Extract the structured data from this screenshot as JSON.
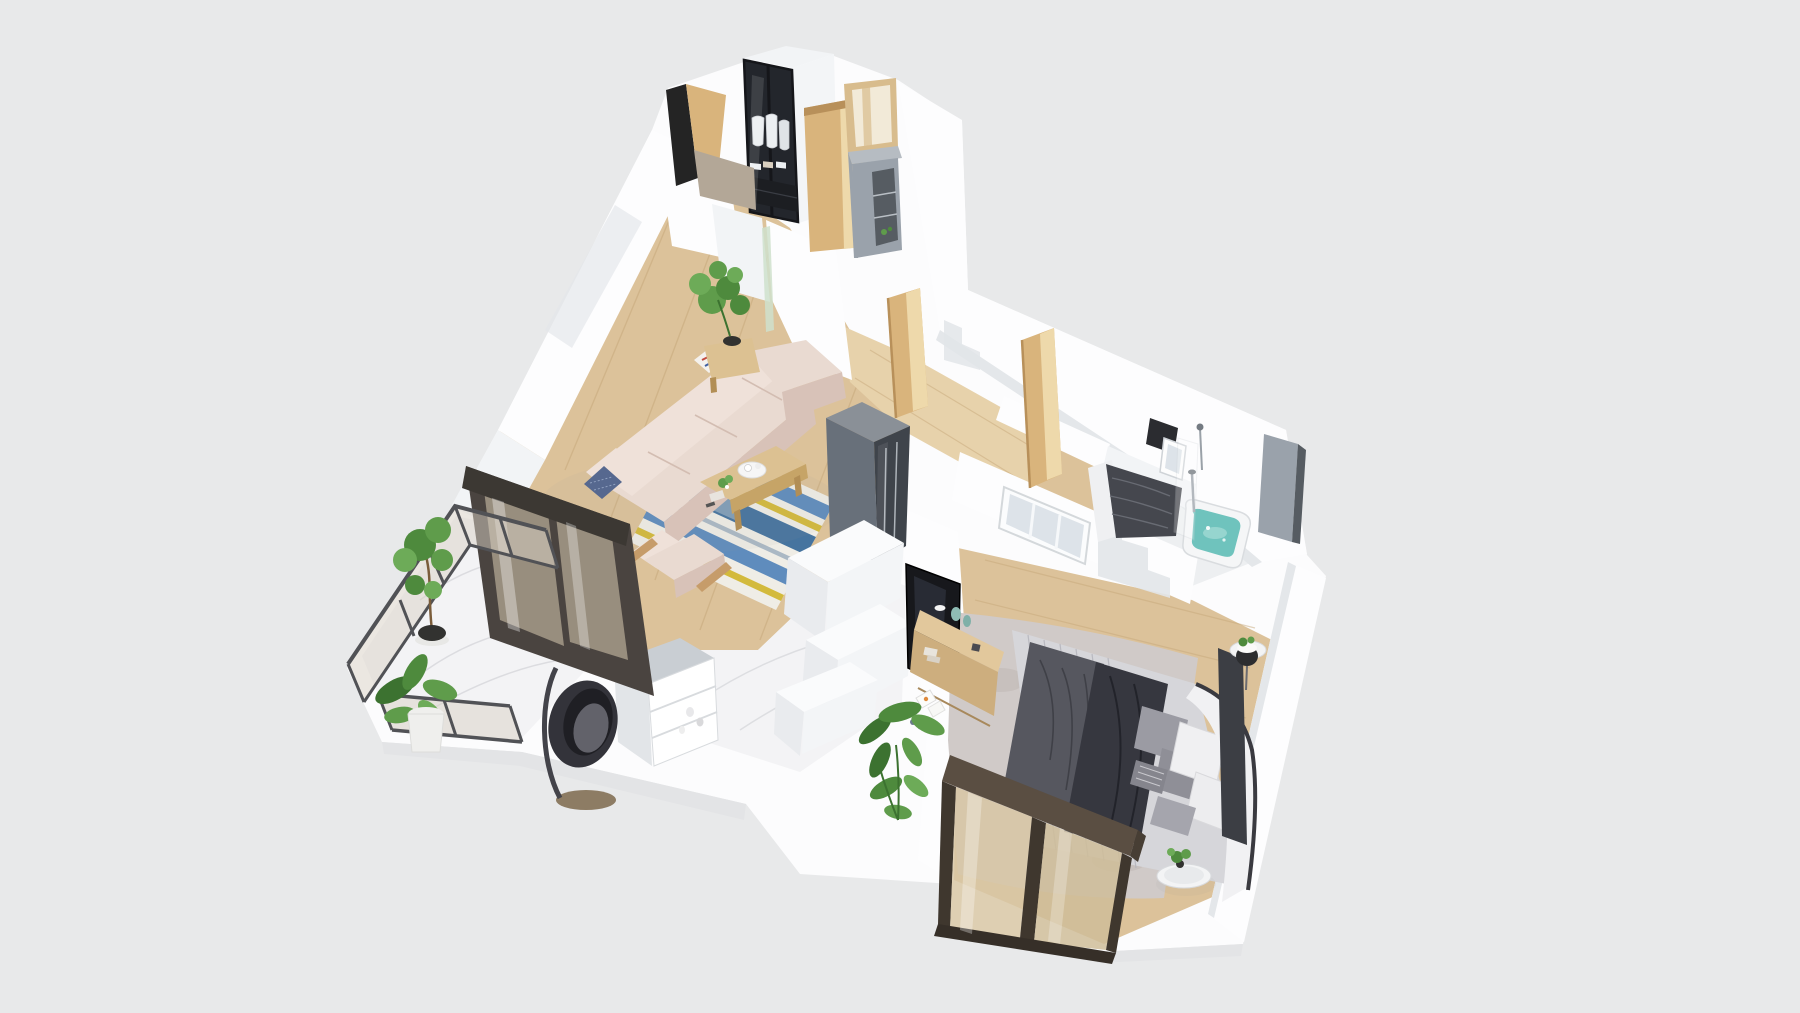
{
  "scene": {
    "kind": "3d-floorplan-render",
    "view": "isometric-birdseye-cutaway",
    "background": "#e8e9ea",
    "rooms": [
      {
        "name": "entrance-hall",
        "items": [
          "wardrobe-with-glass-doors",
          "black-entry-door",
          "open-wood-door",
          "mirrored-doorway",
          "gray-shoe-cabinet"
        ]
      },
      {
        "name": "living-room",
        "items": [
          "l-shaped-beige-sofa",
          "chaise",
          "navy-pillow",
          "art-pillow",
          "striped-rug",
          "wood-coffee-table",
          "armchair",
          "potted-monstera",
          "plant-stand"
        ]
      },
      {
        "name": "kitchen",
        "items": [
          "gray-fridge-cabinet",
          "white-counters",
          "niche-shelf-unit",
          "marble-floor"
        ]
      },
      {
        "name": "balcony",
        "items": [
          "glass-railing",
          "sliding-glass-door",
          "tall-potted-plant",
          "banana-plant",
          "hanging-egg-chair",
          "marble-floor"
        ]
      },
      {
        "name": "hallway",
        "items": [
          "wood-floor",
          "open-wood-door-a",
          "open-wood-door-b"
        ]
      },
      {
        "name": "second-bedroom",
        "items": [
          "bed-dark-bedding",
          "back-window",
          "dark-headboard-panel"
        ]
      },
      {
        "name": "bathroom",
        "items": [
          "filled-bathtub",
          "shower-fixture",
          "glass-screen",
          "gray-wall-panel"
        ]
      },
      {
        "name": "master-bedroom",
        "items": [
          "double-bed-gray-bedding",
          "dark-throw",
          "pillow-group",
          "curved-white-headboard",
          "fluffy-rug",
          "tv",
          "wood-tv-console",
          "decor-vases",
          "large-potted-plant",
          "nightstand-ledge",
          "plant-trays",
          "white-window",
          "dark-frame-picture-window"
        ]
      }
    ]
  },
  "colors": {
    "bg": "#e8e9ea",
    "slab": "#fcfcfd",
    "slabSide": "#e3e4e6",
    "shadow": "#9a9a9a",
    "wood": "#dcc29a",
    "woodLight": "#e7d2ab",
    "woodLine": "#c8a97c",
    "marble": "#f3f3f5",
    "marbleVein": "#d8d9dd",
    "wallA": "#fdfdfe",
    "wallB": "#f2f4f6",
    "wallC": "#e4e7ea",
    "stepShade": "#e2e5e9",
    "glassDark": "#23262c",
    "glassEdge": "#15161a",
    "clothesWhite": "#eceff2",
    "clothesTan": "#d9cfc0",
    "drawerDark": "#1c1e22",
    "doorBlack": "#242424",
    "doorWood": "#d9b47c",
    "doorWoodDeep": "#b8905a",
    "doorWoodLight": "#eed9ab",
    "greige": "#b3a797",
    "mirrorTan": "#d8bc8d",
    "mirrorIn": "#f2ead8",
    "grayPanel": "#9aa2ab",
    "grayPanelTop": "#b6bcc2",
    "grayPanelDark": "#565c62",
    "greenStrip": "#cfe0cd",
    "fridgeTop": "#8a9097",
    "fridgeL": "#68707a",
    "fridgeR": "#3f444b",
    "fridgeLine": "#aeb4ba",
    "sofaTop": "#e9dad1",
    "sofaBack": "#efe1d9",
    "sofaFront": "#d8c2b8",
    "sofaSeam": "#d3bdb2",
    "sofaWood": "#c69c6a",
    "pillowNavy": "#56688f",
    "artWhite": "#f4f1ed",
    "artRed": "#c24b3f",
    "artBlue": "#3f5fa0",
    "rugBase": "#efede6",
    "rugBlue": "#5f8cbd",
    "rugBlueDeep": "#46749f",
    "rugYellow": "#d3ba3c",
    "rugGray": "#aab8c4",
    "tableWood": "#dcc192",
    "tableEdge": "#c6a467",
    "tableLeg": "#b28e55",
    "trayWhite": "#f6f6f6",
    "plantA": "#4e8a3d",
    "plantB": "#5f9c4b",
    "plantC": "#6dab58",
    "plantDeep": "#3c7230",
    "stem": "#7a5c3a",
    "potDark": "#323230",
    "potWhite": "#efefed",
    "counterTop": "#fafbfc",
    "counterFront": "#e9ebee",
    "counterSide": "#f3f5f7",
    "shelfFrame": "#c9ced3",
    "shelfFace": "#e2e5e8",
    "shelfNiche": "#ffffff",
    "shelfLine": "#d8dbde",
    "railFrame": "#515256",
    "railGlass": "#d9d2c6",
    "sliderFrame": "#4a4440",
    "sliderTop": "#3c3833",
    "sliderGlass": "#cdbfa8",
    "eggSeat": "#33333a",
    "eggInner": "#1f1f24",
    "eggCushion": "#62626a",
    "eggBase": "#8d7c64",
    "eggPole": "#43434a",
    "tvBlack": "#17181c",
    "tvGlow": "#2c2f38",
    "consoleTop": "#e2c89c",
    "consoleFront": "#cdae7e",
    "consoleLine": "#a8895c",
    "teal": "#8fbcb4",
    "tealDeep": "#7fb0a8",
    "bedBase": "#d6d6da",
    "bedStripe": "#b2b2ba",
    "blanketGray": "#56575f",
    "blanketDark": "#3f4047",
    "duvetBlack": "#36373f",
    "duvetFold": "#22232a",
    "pillowGrayA": "#9b9ba3",
    "pillowGrayB": "#8f8f97",
    "pillowGrayC": "#a5a5ad",
    "pillowWhite": "#f0f0f2",
    "pillowStripe": "#85858d",
    "headboard": "#f1f1f3",
    "headboardLine": "#3a3a40",
    "bedLedge": "#3c3e44",
    "rugFluffy": "#d0cac8",
    "rugFluffySpot": "#bdb5b2",
    "trayTop": "#f3f4f5",
    "trayInner": "#e8eaec",
    "trayRim": "#d8dadd",
    "lampDark": "#2c2d30",
    "winBrown": "#5a4e42",
    "winBrownSide": "#473e34",
    "winFrameDark": "#3f372e",
    "winGlass": "#d8c7a4",
    "winGlass2": "#cfbd99",
    "winSill": "#362f28",
    "bed2Duvet": "#45474e",
    "bed2Line": "#686b73",
    "bed2Panel": "#2b2c30",
    "bedWhite": "#eff0f2",
    "windowWhite": "#fbfcfd",
    "windowGlass": "#dde3e9",
    "windowMull": "#f6f8fa",
    "tubBody": "#f5f6f7",
    "tubStroke": "#d9dcdf",
    "water": "#6fc3bd",
    "waterLight": "#9ed8d2",
    "chromeCol": "#9aa1a8",
    "bathFloor": "#edeff1"
  }
}
